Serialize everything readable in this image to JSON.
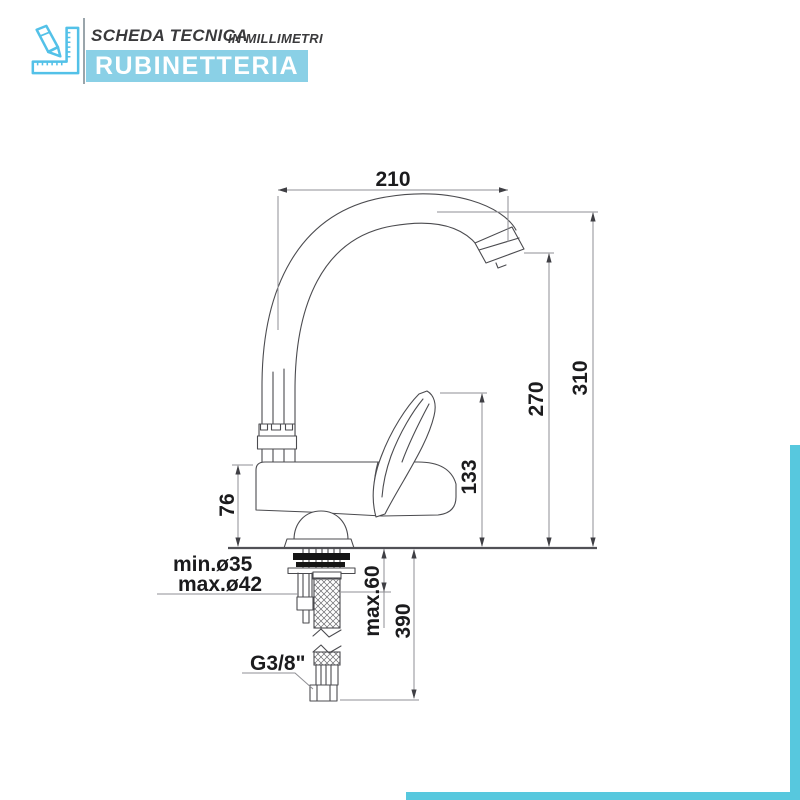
{
  "header": {
    "title": "SCHEDA TECNICA",
    "subtitle": "IN MILLIMETRI",
    "banner": "RUBINETTERIA",
    "icon": "pencil-and-square-ruler"
  },
  "colors": {
    "accent_blue": "#53c1e8",
    "banner_blue": "#8ad0e6",
    "frame_blue": "#57c8de",
    "drawing_line": "#4b4b4f",
    "dimension_line": "#8f8f94",
    "label_text": "#1b1b1d"
  },
  "drawing": {
    "subject": "single-lever kitchen sink mixer tap, side elevation",
    "unit": "mm",
    "dimensions": {
      "spout_reach": "210",
      "total_height": "310",
      "spout_outlet_height": "270",
      "lever_height": "133",
      "body_height": "76",
      "hole_min": "min.ø35",
      "hole_max": "max.ø42",
      "deck_thickness": "max.60",
      "hose_length": "390",
      "connection_thread": "G3/8\""
    }
  }
}
